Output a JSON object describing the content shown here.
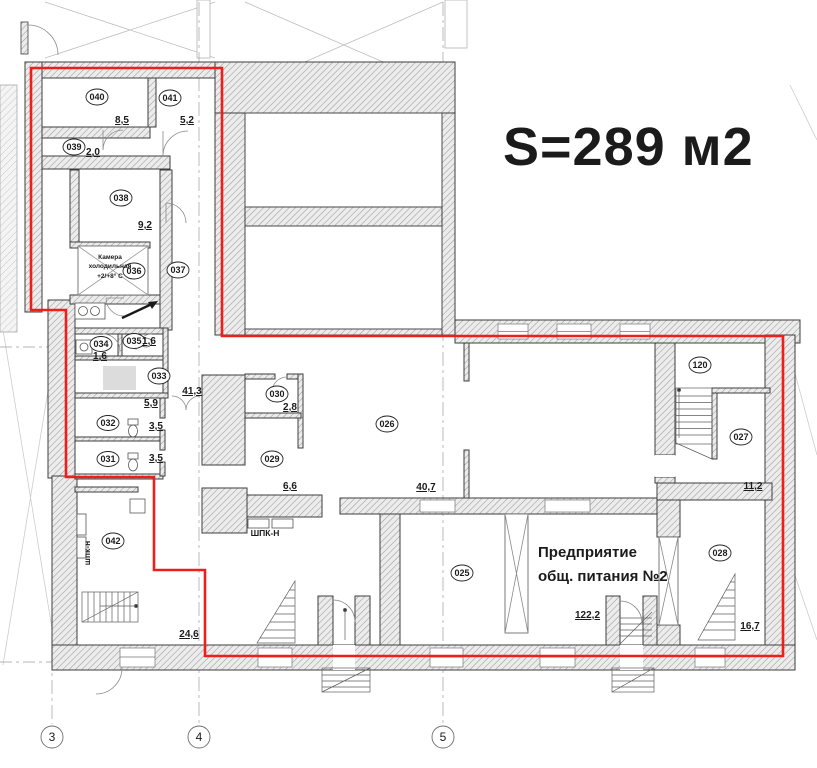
{
  "title": {
    "text": "S=289 м2"
  },
  "rooms": [
    {
      "number": "040",
      "area": "8,5"
    },
    {
      "number": "041",
      "area": "5,2"
    },
    {
      "number": "039",
      "area": "2,0"
    },
    {
      "number": "038",
      "area": "9,2"
    },
    {
      "number": "036",
      "area": ""
    },
    {
      "number": "037",
      "area": ""
    },
    {
      "number": "034",
      "area": "1,6"
    },
    {
      "number": "035",
      "area": "1,6"
    },
    {
      "number": "033",
      "area": "5,9"
    },
    {
      "number": "032",
      "area": "3,5"
    },
    {
      "number": "031",
      "area": "3,5"
    },
    {
      "number": "030",
      "area": "2,8"
    },
    {
      "number": "029",
      "area": "6,6"
    },
    {
      "number": "026",
      "area": "40,7"
    },
    {
      "number": "042",
      "area": "24,6"
    },
    {
      "number": "025",
      "area": ""
    },
    {
      "number": "120",
      "area": ""
    },
    {
      "number": "027",
      "area": "11,2"
    },
    {
      "number": "028",
      "area": "16,7"
    }
  ],
  "hall_area": "41,3",
  "enterprise": {
    "line1": "Предприятие",
    "line2": "общ. питания №2",
    "area": "122,2"
  },
  "cold_room": {
    "line1": "Камера",
    "line2": "холодильная",
    "line3": "+2/+8° С"
  },
  "cabinets": {
    "left_vertical": "шпк-н",
    "center": "ШПК-Н"
  },
  "axes": [
    {
      "label": "3"
    },
    {
      "label": "4"
    },
    {
      "label": "5"
    }
  ],
  "colors": {
    "lease_boundary_red": "#ed1f1a",
    "wall_outline": "#3e3e3e",
    "hatch_line": "#9b9b9b"
  }
}
